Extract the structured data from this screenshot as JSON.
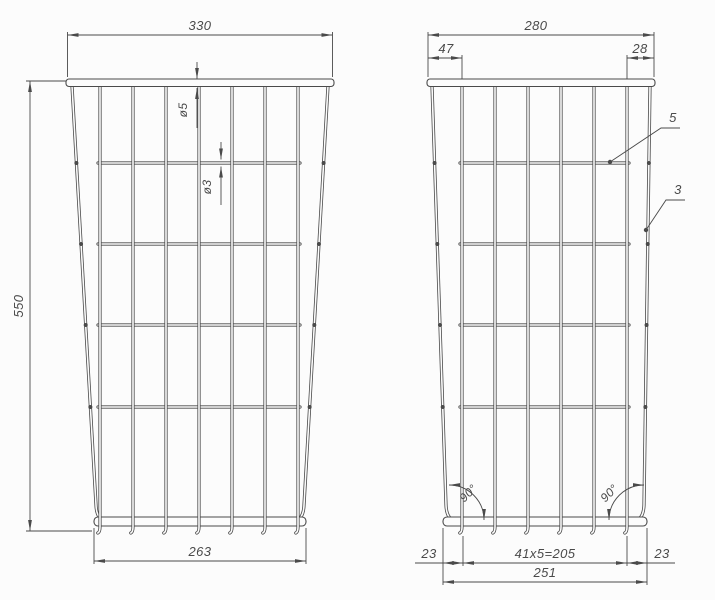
{
  "page": {
    "bg": "#fcfcfc",
    "ink": "#4a4a4a"
  },
  "drawing_title": "wire-basket-two-view-technical-drawing",
  "views": [
    {
      "id": "front-view",
      "rim": {
        "x1": 66,
        "x2": 334,
        "y": 79,
        "h": 7.5
      },
      "bottom_bar": {
        "x1": 94,
        "x2": 306,
        "y": 517,
        "h": 9
      },
      "side_left": {
        "x_top": 72,
        "x_bot": 96
      },
      "side_right": {
        "x_top": 328,
        "x_bot": 304
      },
      "wire_top_y": 86,
      "side_bot_y": 505,
      "verticals": [
        100,
        133,
        166,
        199,
        232,
        265,
        298
      ],
      "vertical_bot_y": 533,
      "horizontals": [
        163,
        244,
        325,
        407
      ],
      "h_x1": 98,
      "h_x2": 300,
      "nubs": [
        163,
        244,
        325,
        407
      ]
    },
    {
      "id": "side-view",
      "rim": {
        "x1": 427,
        "x2": 655,
        "y": 79,
        "h": 7.5
      },
      "bottom_bar": {
        "x1": 443,
        "x2": 647,
        "y": 517,
        "h": 9
      },
      "side_left": {
        "x_top": 432,
        "x_bot": 446
      },
      "side_right": {
        "x_top": 650,
        "x_bot": 644
      },
      "wire_top_y": 86,
      "side_bot_y": 505,
      "verticals": [
        462,
        495,
        528,
        561,
        594,
        627
      ],
      "vertical_bot_y": 533,
      "horizontals": [
        163,
        244,
        325,
        407
      ],
      "h_x1": 460,
      "h_x2": 629,
      "nubs": [
        163,
        244,
        325,
        407
      ]
    }
  ],
  "h_dims": [
    {
      "label": "330",
      "x1": 67.5,
      "x2": 332.5,
      "y": 35,
      "ext_from": 77,
      "ext1": true,
      "ext2": true,
      "label_x": 200
    },
    {
      "label": "280",
      "x1": 428,
      "x2": 654,
      "y": 35,
      "ext_from": 77,
      "ext1": true,
      "ext2": true,
      "label_x": 536
    },
    {
      "label": "47",
      "x1": 428,
      "x2": 462,
      "y": 58,
      "ext_from": 79,
      "ext1": false,
      "ext2": true,
      "label_x": 446
    },
    {
      "label": "28",
      "x1": 627,
      "x2": 654,
      "y": 58,
      "ext_from": 79,
      "ext1": true,
      "ext2": false,
      "label_x": 640
    },
    {
      "label": "263",
      "x1": 94,
      "x2": 306,
      "y": 561,
      "ext_from": 528,
      "ext1": true,
      "ext2": true,
      "label_x": 200
    },
    {
      "label": "23",
      "x1": 443,
      "x2": 463,
      "y": 563,
      "ext1": false,
      "ext2": false,
      "label_x": 429,
      "tail": "left"
    },
    {
      "label": "41x5=205",
      "x1": 463,
      "x2": 627,
      "y": 563,
      "ext_from": 536,
      "ext1": true,
      "ext2": true,
      "label_x": 545
    },
    {
      "label": "23",
      "x1": 627,
      "x2": 647,
      "y": 563,
      "ext1": false,
      "ext2": false,
      "label_x": 662,
      "tail": "right"
    },
    {
      "label": "251",
      "x1": 443,
      "x2": 647,
      "y": 582,
      "ext_from": 528,
      "ext1": true,
      "ext2": true,
      "label_x": 545
    }
  ],
  "v_dims": [
    {
      "label": "550",
      "x": 30,
      "y1": 81,
      "y2": 531,
      "label_x": 23,
      "label_y": 306,
      "exts": [
        [
          66,
          81,
          26,
          81
        ],
        [
          92,
          531,
          26,
          531
        ]
      ]
    }
  ],
  "diameter_callouts": [
    {
      "label": "ø5",
      "x": 197,
      "gap_top": 79,
      "gap_bot": 88,
      "tail_to": 128,
      "approach_from": 62,
      "label_x": 187,
      "label_y": 110
    },
    {
      "label": "ø3",
      "x": 221,
      "gap_top": 159.5,
      "gap_bot": 166.5,
      "tail_to": 205,
      "approach_from": 142,
      "label_x": 211,
      "label_y": 187
    }
  ],
  "leaders": [
    {
      "label": "5",
      "label_x": 673,
      "label_y": 122,
      "path": [
        [
          680,
          128
        ],
        [
          661,
          128
        ],
        [
          610,
          162
        ]
      ]
    },
    {
      "label": "3",
      "label_x": 678,
      "label_y": 194,
      "path": [
        [
          685,
          200
        ],
        [
          666,
          200
        ],
        [
          646,
          230
        ]
      ]
    }
  ],
  "angle_dims": [
    {
      "label": "90°",
      "cx": 449,
      "cy": 520,
      "r": 35,
      "sweep": 0,
      "p1": [
        484,
        520
      ],
      "p2": [
        449,
        485
      ],
      "arrow1_deg": 90,
      "arrow2_deg": 180,
      "label_x": 471,
      "label_y": 496,
      "label_rot": -45
    },
    {
      "label": "90°",
      "cx": 644,
      "cy": 520,
      "r": 35,
      "sweep": 1,
      "p1": [
        609,
        520
      ],
      "p2": [
        644,
        485
      ],
      "arrow1_deg": 90,
      "arrow2_deg": 0,
      "label_x": 612,
      "label_y": 496,
      "label_rot": -45
    }
  ]
}
